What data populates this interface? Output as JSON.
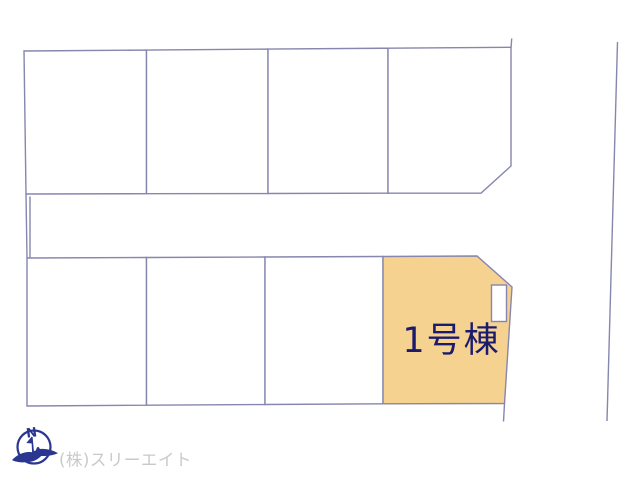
{
  "plan": {
    "title_label": "1号棟",
    "line_color": "#8686AE",
    "highlight_fill": "#F6D291",
    "label_color": "#1B1B6E",
    "lot_fill": "#FFFFFF",
    "top_row_lot_count": 4,
    "bottom_row_lot_count": 4,
    "highlighted_lot_position": "bottom-right"
  },
  "footer": {
    "compass_label": "N",
    "company_label": "(株)スリーエイト",
    "logo_color": "#2A3690",
    "company_color": "#C9C9C9"
  }
}
